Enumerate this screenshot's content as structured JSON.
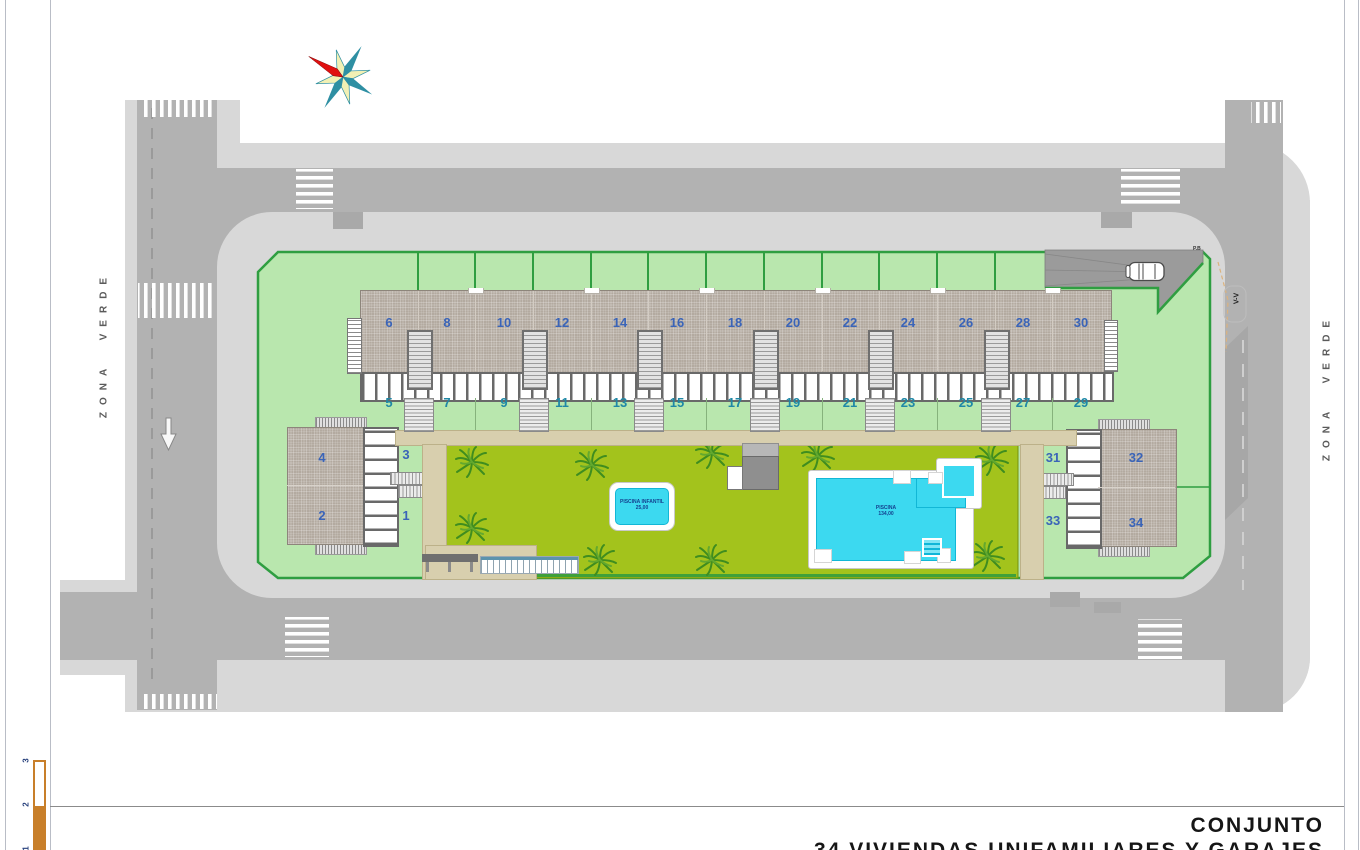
{
  "page": {
    "title_line1": "CONJUNTO",
    "title_line2": "34 VIVIENDAS UNIFAMILIARES Y GARAJES"
  },
  "plan": {
    "zona_verde_left": "ZONA VERDE",
    "zona_verde_right": "ZONA VERDE",
    "section_marker": "V-V",
    "entry_marker": "P.B",
    "small_pool": {
      "line1": "PISCINA INFANTIL",
      "line2": "25,00"
    },
    "large_pool": {
      "line1": "PISCINA",
      "line2": "134,00"
    },
    "units": {
      "roof_even": [
        "6",
        "8",
        "10",
        "12",
        "14",
        "16",
        "18",
        "20",
        "22",
        "24",
        "26",
        "28",
        "30"
      ],
      "garden_odd": [
        "5",
        "7",
        "9",
        "11",
        "13",
        "15",
        "17",
        "19",
        "21",
        "23",
        "25",
        "27",
        "29"
      ],
      "left_block": {
        "roof_upper": "4",
        "roof_lower": "2",
        "garden_upper": "3",
        "garden_lower": "1"
      },
      "right_block": {
        "roof_upper": "32",
        "roof_lower": "34",
        "garden_upper": "31",
        "garden_lower": "33"
      }
    },
    "scale_ticks": [
      "3",
      "2",
      "1"
    ]
  },
  "colors": {
    "road": "#b2b2b2",
    "sidewalk": "#d8d8d8",
    "site_green": "#b9e7ae",
    "site_border": "#2f9e41",
    "courtyard_green": "#a3c31c",
    "roof": "#b3aaa0",
    "pool_water": "#3cd9f0",
    "path_tan": "#d8cfae",
    "unit_even": "#3a64b8",
    "unit_odd": "#1f88a6",
    "scale_orange": "#c87f2a",
    "compass_red": "#e01010",
    "compass_teal": "#2e8fa3"
  }
}
